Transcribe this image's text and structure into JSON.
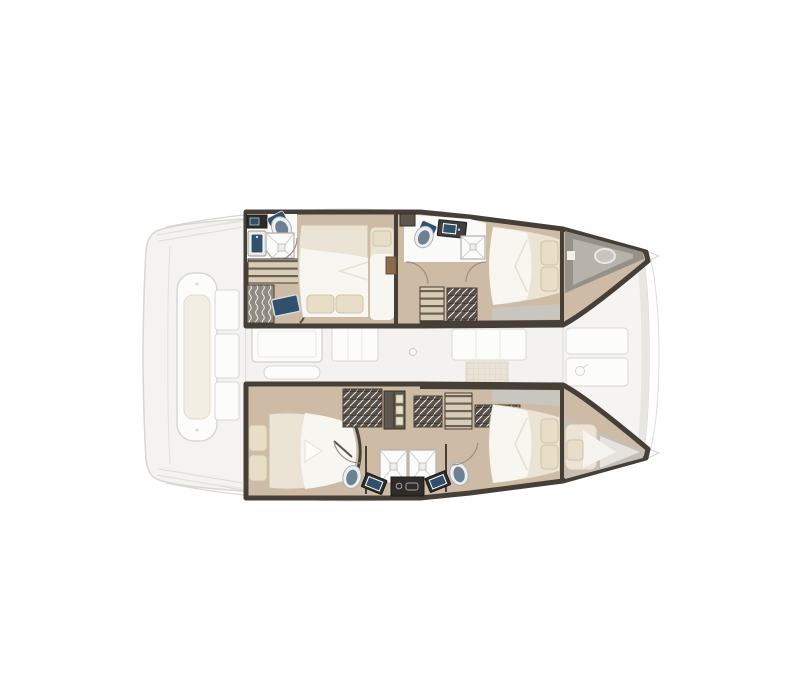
{
  "canvas": {
    "width": 800,
    "height": 700,
    "background": "#ffffff"
  },
  "plan": {
    "subject": "catamaran-yacht-interior-floor-plan",
    "view": "top-down",
    "bow_direction": "right",
    "stern_direction": "left",
    "hulls": {
      "port": {
        "placement": "top",
        "rooms": [
          {
            "id": "port-aft-head",
            "type": "bathroom",
            "fixtures": [
              "vanity",
              "sink",
              "toilet",
              "corner-shower"
            ]
          },
          {
            "id": "port-aft-cabin",
            "type": "double-cabin",
            "fixtures": [
              "double-bed",
              "two-pillows",
              "single-berth",
              "wardrobe-shelves",
              "hanging-locker",
              "tv-screen"
            ]
          },
          {
            "id": "port-forward-head",
            "type": "bathroom",
            "fixtures": [
              "toilet",
              "vanity-sink",
              "shower"
            ]
          },
          {
            "id": "port-companionway",
            "type": "stairwell",
            "fixtures": [
              "steps",
              "storage-locker",
              "cabinet",
              "door-arcs"
            ]
          },
          {
            "id": "port-forward-cabin",
            "type": "double-cabin",
            "fixtures": [
              "double-bed",
              "two-pillows"
            ]
          },
          {
            "id": "port-forepeak",
            "type": "bow-locker",
            "fixtures": [
              "deck-hatch"
            ]
          }
        ]
      },
      "starboard": {
        "placement": "bottom",
        "rooms": [
          {
            "id": "starboard-aft-cabin",
            "type": "double-cabin",
            "fixtures": [
              "double-bed",
              "two-pillows",
              "hanging-locker",
              "shelf-unit"
            ]
          },
          {
            "id": "starboard-companionway",
            "type": "stairwell",
            "fixtures": [
              "steps",
              "storage-locker",
              "storage-locker"
            ]
          },
          {
            "id": "starboard-twin-heads",
            "type": "bathroom",
            "fixtures": [
              "two-showers",
              "two-toilets",
              "two-sinks",
              "center-console"
            ]
          },
          {
            "id": "starboard-forward-cabin",
            "type": "double-cabin",
            "fixtures": [
              "double-bed",
              "two-pillows"
            ]
          },
          {
            "id": "starboard-forepeak",
            "type": "berth",
            "fixtures": [
              "single-berth",
              "pillow"
            ]
          }
        ]
      }
    },
    "bridgedeck": {
      "cockpit": {
        "placement": "aft",
        "fixtures": [
          "lounge-bench",
          "bench-cushion",
          "three-seats",
          "transom-steps"
        ]
      },
      "saloon": {
        "placement": "center",
        "fixtures": [
          "dining-table",
          "bench-seat",
          "galley-island",
          "counter-unit",
          "floor-hatch",
          "door-knob"
        ]
      },
      "foredeck": {
        "placement": "forward",
        "fixtures": [
          "deck-panel",
          "deck-panel",
          "deck-hatch-ring",
          "bow-tips",
          "bow-bridle"
        ]
      }
    }
  },
  "colors": {
    "background": "#ffffff",
    "floor-tan": "#cdbba5",
    "floor-tan-light": "#d9ccb7",
    "bulkhead-dark": "#453f38",
    "bulkhead-mid": "#5e574d",
    "bed-cream": "#ebe3d3",
    "bed-white": "#f8f6f0",
    "pillow": "#e8ddc6",
    "pillow-edge": "#cfc2a7",
    "bathroom-white": "#fafaf8",
    "shower-line": "#b3b1ad",
    "toilet-body": "#b4bec7",
    "toilet-dark": "#8595a3",
    "toilet-inner": "#6e8191",
    "sink-navy": "#30506c",
    "sink-frame": "#3f3f3f",
    "stripe-dark": "#57514a",
    "wave-gray": "#8f8a82",
    "tread-dark": "#6b6257",
    "bow-gray": "#95908a",
    "bow-gray-light": "#b7b2aa",
    "walkway-gray": "#c9c6c0",
    "faded-fill": "#f4f3f1",
    "faded-white": "#fcfcfb",
    "faded-stroke": "#d9d7d3",
    "faded-tan": "#e9e2d7",
    "cushion": "#f2eee4",
    "arc-line": "#9a9184"
  }
}
